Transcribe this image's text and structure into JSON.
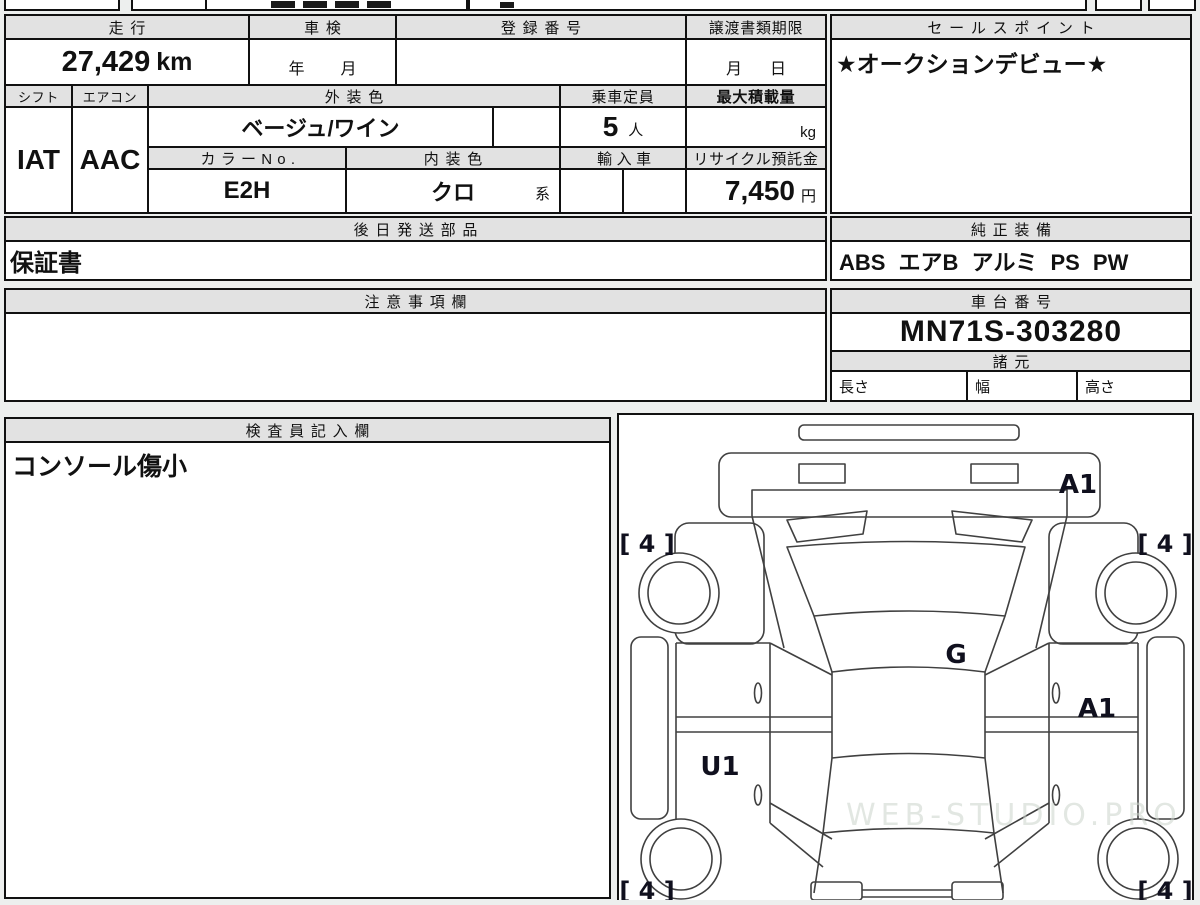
{
  "fields": {
    "mileage": {
      "label": "走行",
      "value": "27,429",
      "unit": "km"
    },
    "inspection": {
      "label": "車検",
      "year_suffix": "年",
      "month_suffix": "月"
    },
    "registration": {
      "label": "登録番号",
      "value": ""
    },
    "transfer_deadline": {
      "label": "譲渡書類期限",
      "month_suffix": "月",
      "day_suffix": "日"
    },
    "shift": {
      "label": "シフト",
      "value": "IAT"
    },
    "aircon": {
      "label": "エアコン",
      "value": "AAC"
    },
    "exterior_color": {
      "label": "外装色",
      "value": "ベージュ/ワイン"
    },
    "capacity": {
      "label": "乗車定員",
      "value": "5",
      "unit": "人"
    },
    "max_load": {
      "label": "最大積載量",
      "value": "",
      "unit": "kg"
    },
    "color_no": {
      "label": "カラーNo.",
      "value": "E2H"
    },
    "interior_color": {
      "label": "内装色",
      "value": "クロ",
      "suffix": "系"
    },
    "imported": {
      "label": "輸入車",
      "value": ""
    },
    "recycle_deposit": {
      "label": "リサイクル預託金",
      "value": "7,450",
      "unit": "円"
    }
  },
  "sales_point": {
    "label": "セールスポイント",
    "value": "★オークションデビュー★"
  },
  "shipped_later_parts": {
    "label": "後日発送部品",
    "value": "保証書"
  },
  "genuine_equipment": {
    "label": "純正装備",
    "value": "ABS エアB アルミ PS PW"
  },
  "cautions": {
    "label": "注意事項欄",
    "value": ""
  },
  "chassis_number": {
    "label": "車台番号",
    "value": "MN71S-303280"
  },
  "specifications": {
    "label": "諸元",
    "length_label": "長さ",
    "width_label": "幅",
    "height_label": "高さ",
    "length_value": "",
    "width_value": "",
    "height_value": ""
  },
  "inspector_notes": {
    "label": "検査員記入欄",
    "value": "コンソール傷小"
  },
  "damage_diagram": {
    "front_panel_mark": "A1",
    "front_left_tire_mark": "[ 4 ]",
    "front_right_tire_mark": "[ 4 ]",
    "windshield_mark": "G",
    "left_door_mark": "U1",
    "right_rear_panel_mark": "A1",
    "rear_left_tire_mark": "[ 4 ]",
    "rear_right_tire_mark": "[ 4 ]",
    "watermark": "WEB-STUDIO.PRO"
  },
  "colors": {
    "header_bg": "#e2e2e2",
    "border": "#111111",
    "page_bg": "#edefee",
    "diagram_line": "#404040"
  }
}
